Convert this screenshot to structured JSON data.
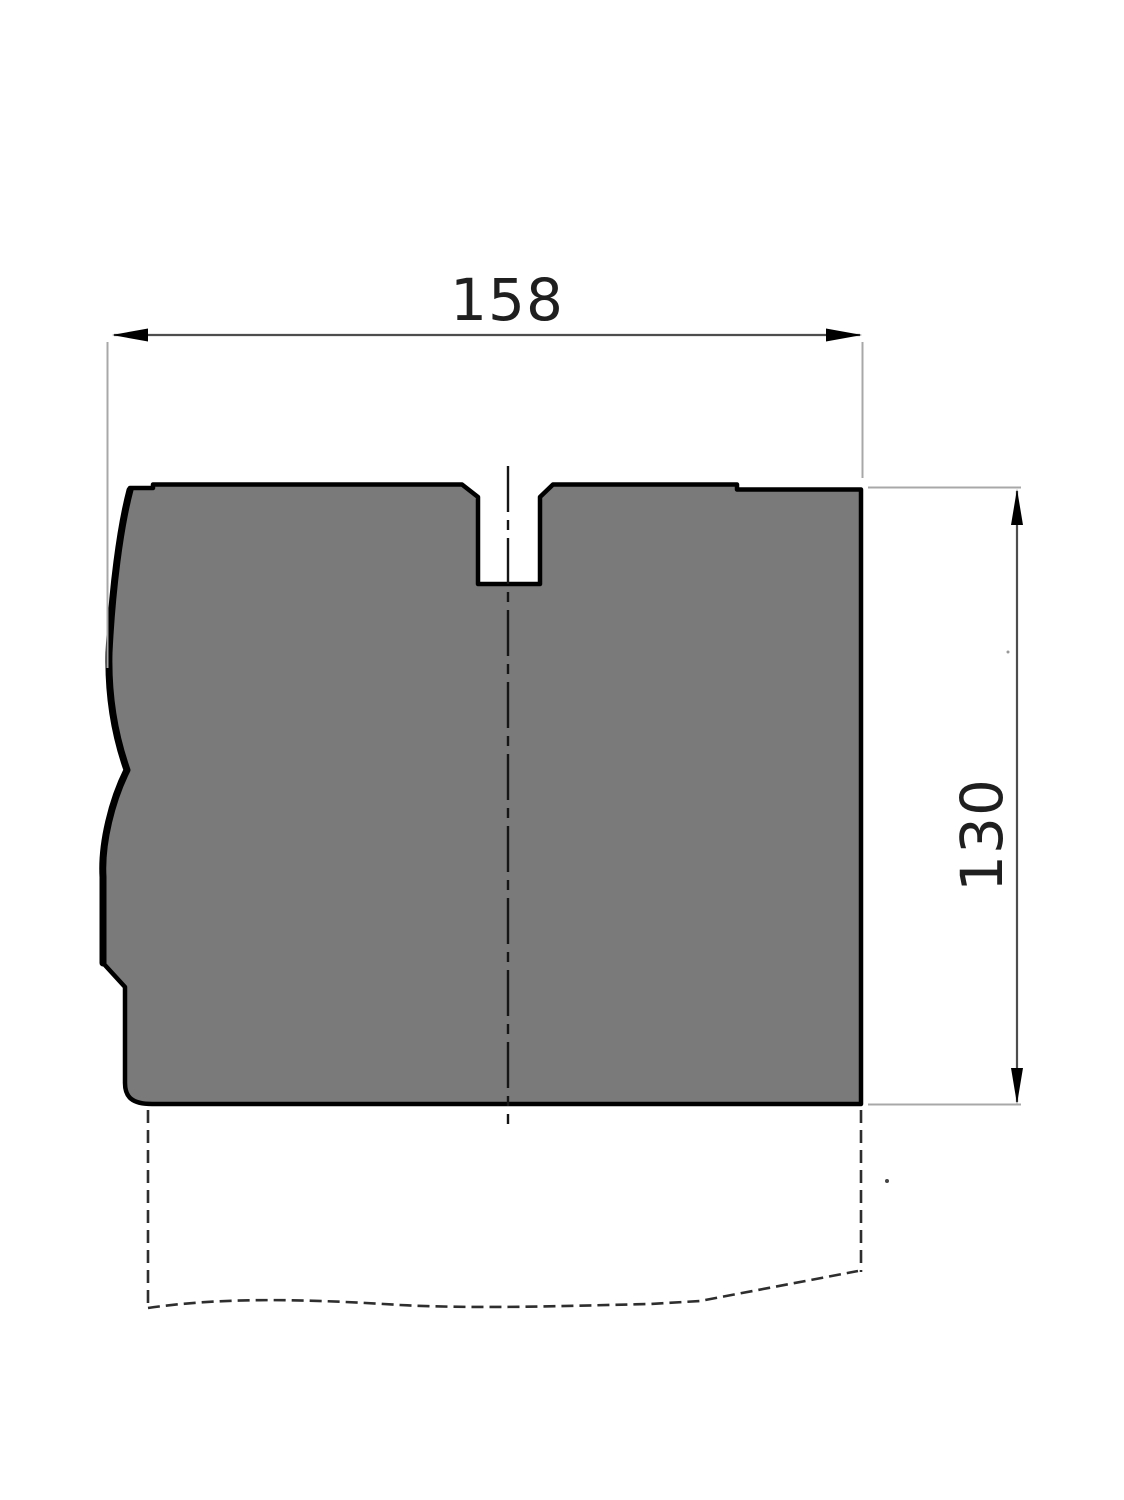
{
  "drawing": {
    "title": "die-block-section-view",
    "part": {
      "fill_color": "#7a7a7a",
      "outline_color": "#000000"
    },
    "dimensions": {
      "width": {
        "label": "158",
        "orientation": "horizontal"
      },
      "height": {
        "label": "130",
        "orientation": "vertical"
      }
    },
    "styles": {
      "dimension_line_color": "#4d4d4d",
      "extension_line_color": "#a8a8a8",
      "centerline_color": "#151515",
      "phantom_line_color": "#2e2e2e",
      "background_color": "#ffffff"
    }
  }
}
